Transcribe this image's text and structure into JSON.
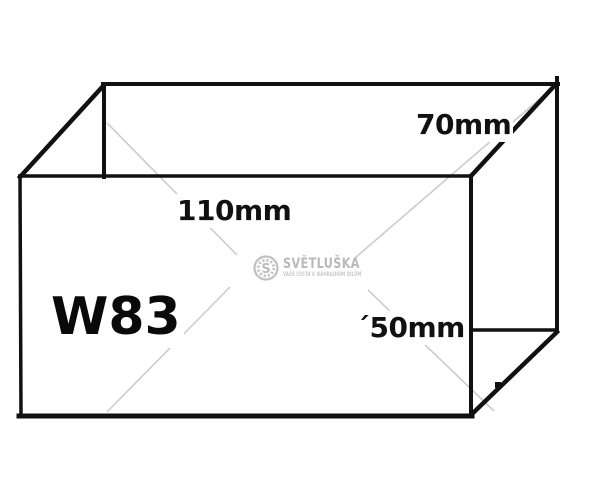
{
  "page": {
    "background": "#ffffff"
  },
  "diagram": {
    "part_code": "W83",
    "dimension_labels": {
      "depth": "70mm",
      "width": "110mm",
      "height": "´50mm"
    },
    "watermark": {
      "logo_letter": "S",
      "brand": "SVĚTLUŠKA",
      "tagline": "VAŠE CESTA K NÁHRADNÍM DÍLŮM"
    },
    "colors": {
      "line": "#111111",
      "label_text": "#111111",
      "watermark_gray": "#bdbdbd",
      "watermark_line_gray": "#cccccc"
    }
  }
}
